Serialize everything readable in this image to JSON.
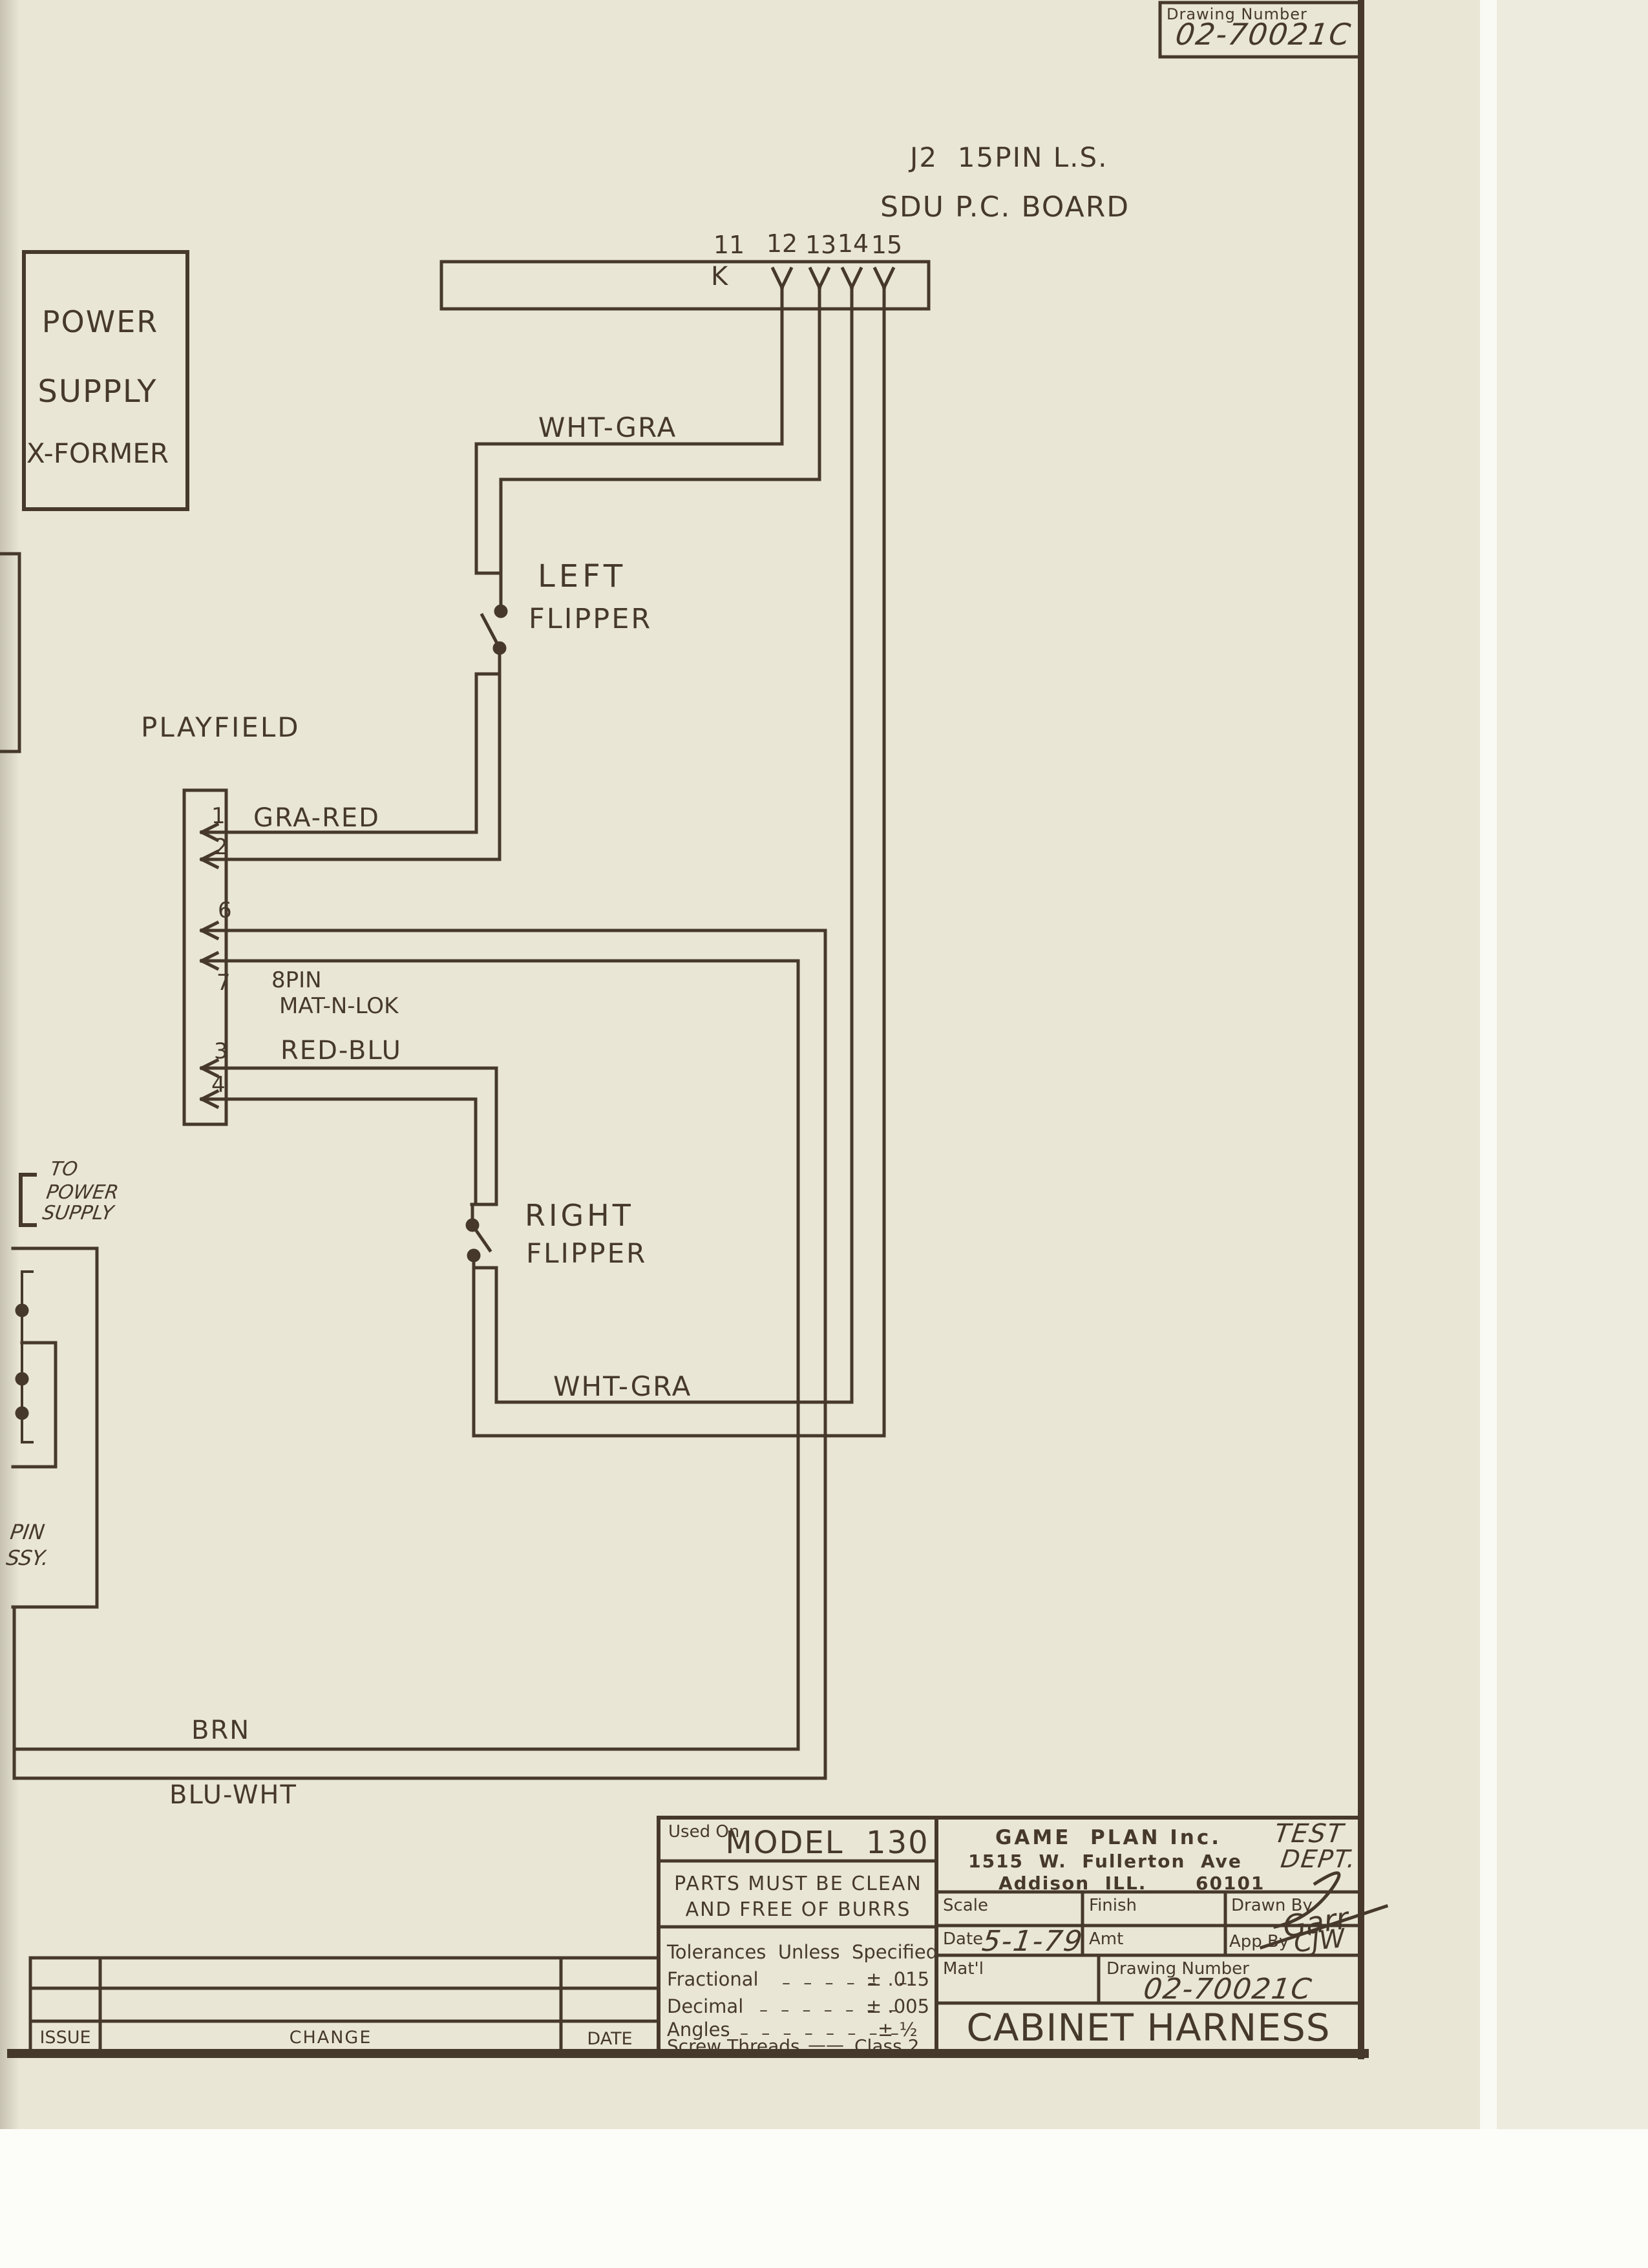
{
  "diagram": {
    "drawing_number_box": {
      "label": "Drawing Number",
      "value": "02-70021C"
    },
    "header": {
      "line1": "J2  15PIN L.S.",
      "line2": "SDU P.C. BOARD"
    },
    "sdu": {
      "k": "K",
      "pins": [
        "11",
        "12",
        "13",
        "14",
        "15"
      ]
    },
    "power_box": [
      "POWER",
      "SUPPLY",
      "X-FORMER"
    ],
    "labels": {
      "wht_gra_top": "WHT-GRA",
      "left_flipper_1": "LEFT",
      "left_flipper_2": "FLIPPER",
      "playfield": "PLAYFIELD",
      "gra_red": "GRA-RED",
      "pin8_line1": "8PIN",
      "pin8_line2": "MAT-N-LOK",
      "red_blu": "RED-BLU",
      "to_power_1": "TO",
      "to_power_2": "POWER",
      "to_power_3": "SUPPLY",
      "right_flipper_1": "RIGHT",
      "right_flipper_2": "FLIPPER",
      "wht_gra_bottom": "WHT-GRA",
      "pin_assy_1": "PIN",
      "pin_assy_2": "SSY.",
      "brn": "BRN",
      "blu_wht": "BLU-WHT"
    },
    "playfield_pins": [
      "1",
      "2",
      "6",
      "7",
      "3",
      "4"
    ]
  },
  "title_block": {
    "used_on": "Used On",
    "model": "MODEL  130",
    "parts_line1": "PARTS MUST BE CLEAN",
    "parts_line2": "AND FREE OF BURRS",
    "tolerances_title": "Tolerances  Unless  Specified",
    "tolerance_rows": [
      {
        "name": "Fractional",
        "dashes": "– – – – –  –",
        "value": "± .015"
      },
      {
        "name": "Decimal",
        "dashes": "– – – – – – –",
        "value": "± .005"
      },
      {
        "name": "Angles",
        "dashes": "– – – – – – – –",
        "value": "± ½"
      }
    ],
    "screw_row": {
      "name": "Screw Threads",
      "dashes": "——",
      "value": "Class 2"
    },
    "company": {
      "name": "GAME  PLAN Inc.",
      "dept1": "TEST",
      "address": "1515  W.  Fullerton  Ave",
      "dept2": "DEPT.",
      "city": "Addison  ILL.",
      "zip": "60101"
    },
    "scale_label": "Scale",
    "finish_label": "Finish",
    "drawn_by_label": "Drawn By",
    "drawn_by_sig": "Garr",
    "date_label": "Date",
    "date_value": "5-1-79",
    "amt_label": "Amt",
    "app_by_label": "App By",
    "app_by_sig": "CJW",
    "matl_label": "Mat'l",
    "drawing_number_label": "Drawing Number",
    "drawing_number_value": "02-70021C",
    "title": "CABINET HARNESS"
  },
  "revision_table": {
    "issue": "ISSUE",
    "change": "CHANGE",
    "date": "DATE"
  },
  "colors": {
    "ink": "#46392b",
    "paper": "#e9e6d6"
  }
}
